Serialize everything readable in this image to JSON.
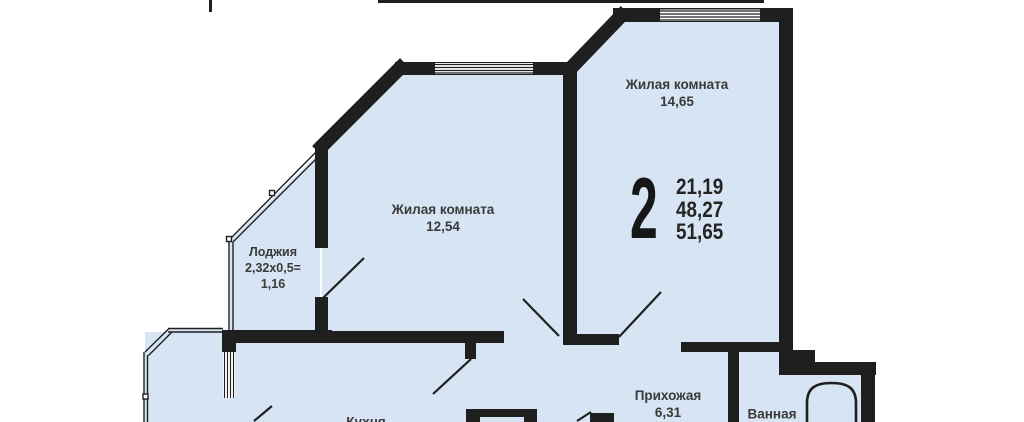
{
  "plan": {
    "title": "apartment-floor-plan",
    "colors": {
      "room_fill": "#d6e4f4",
      "wall": "#1f1f1f",
      "text": "#3a3a3a",
      "background": "#ffffff"
    },
    "summary": {
      "rooms_count": "2",
      "area_values": [
        "21,19",
        "48,27",
        "51,65"
      ]
    },
    "rooms": [
      {
        "name": "Жилая комната",
        "area": "14,65"
      },
      {
        "name": "Жилая комната",
        "area": "12,54"
      },
      {
        "name": "Лоджия",
        "formula": "2,32х0,5=",
        "area": "1,16"
      },
      {
        "name": "Прихожая",
        "area": "6,31"
      },
      {
        "name": "Ванная"
      },
      {
        "name": "Кухня"
      }
    ]
  }
}
